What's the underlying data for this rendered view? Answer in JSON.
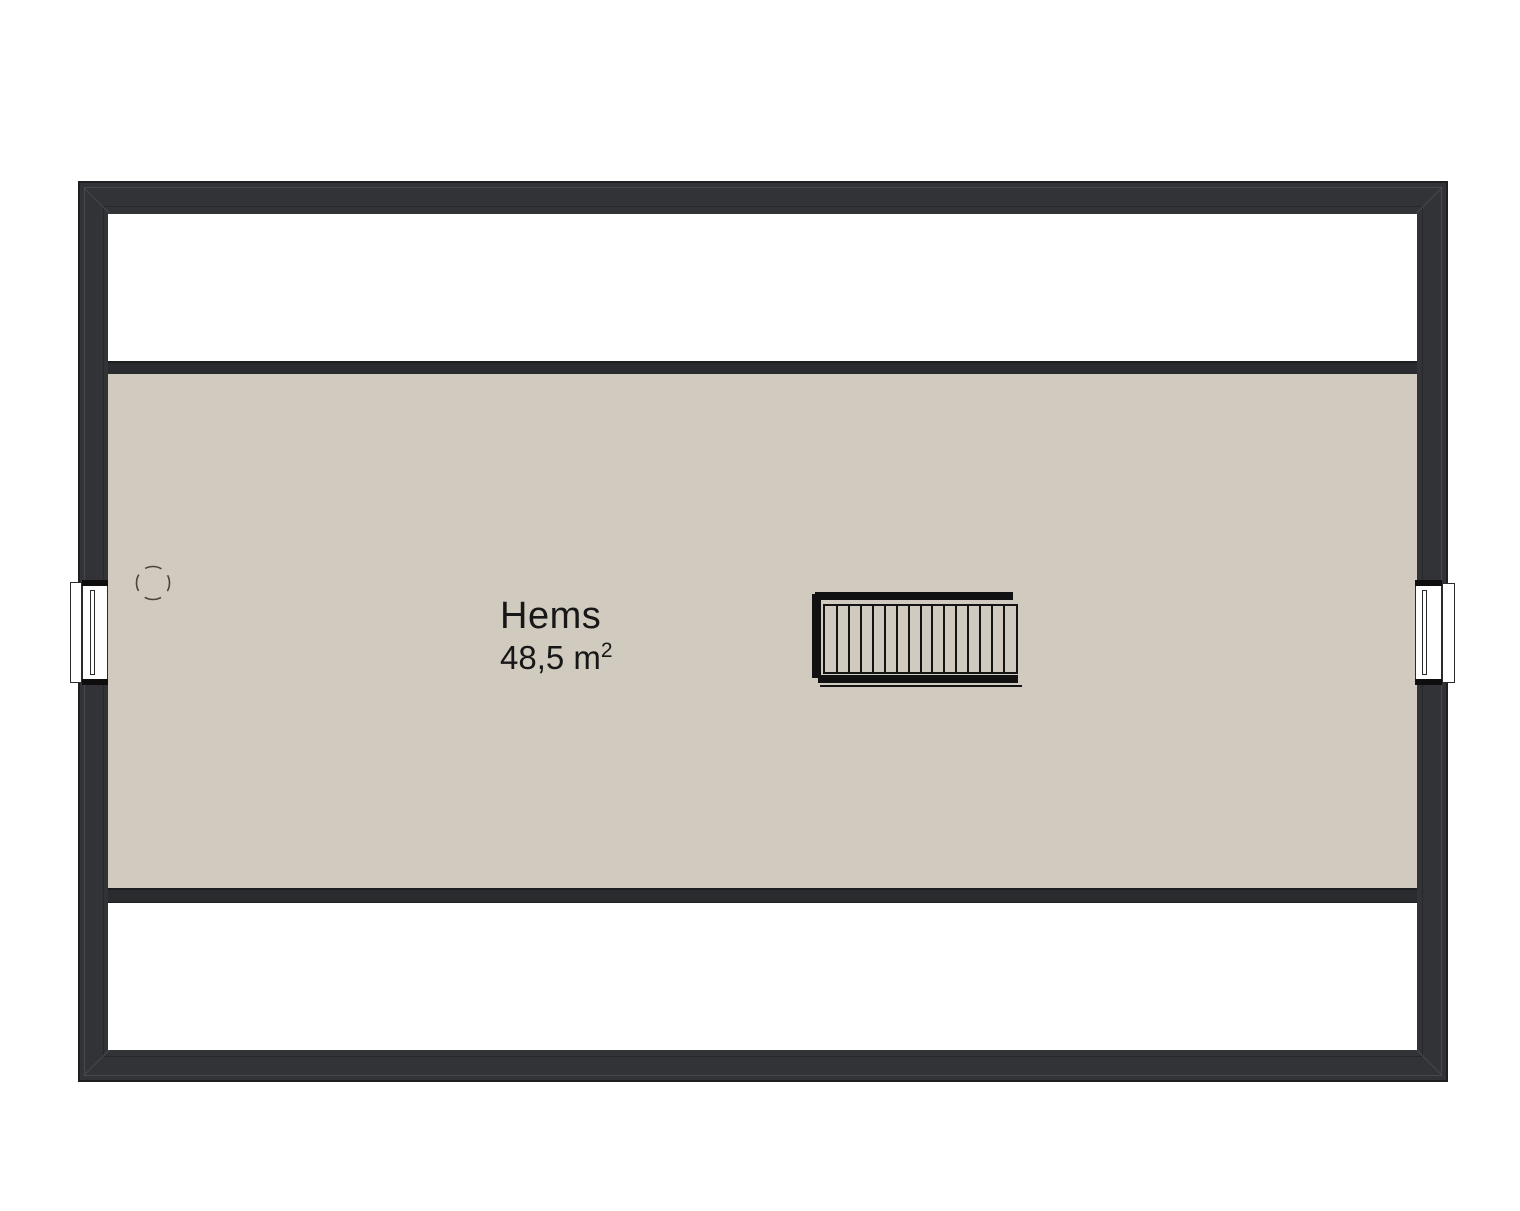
{
  "plan": {
    "title": "attic-floor-plan",
    "room": {
      "name": "Hems",
      "area_text": "48,5 m",
      "area_exponent": "2"
    },
    "stair": {
      "tread_count": 15
    },
    "colors": {
      "wall": "#323336",
      "knee_wall": "#2a2b2e",
      "floor": "#d1cabf",
      "line": "#141414",
      "background": "#ffffff"
    },
    "icons": {
      "stair": "staircase-symbol",
      "window_left": "window-symbol",
      "window_right": "window-symbol",
      "chimney": "dashed-circle-symbol"
    }
  }
}
